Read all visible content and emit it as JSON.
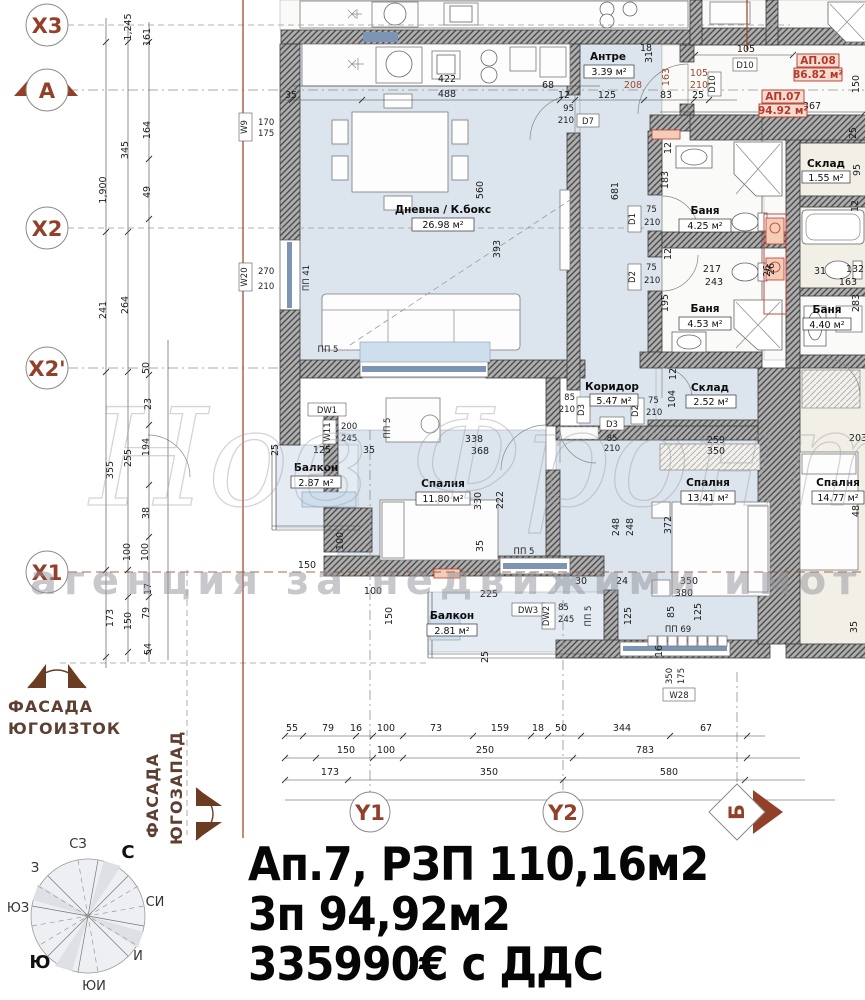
{
  "title": {
    "l1": "Ап.7, РЗП 110,16м2",
    "l2": "3п 94,92м2",
    "l3": "335990€ с ДДС"
  },
  "grid": {
    "x3": "X3",
    "a": "A",
    "x2": "X2",
    "x2p": "X2'",
    "x1": "X1",
    "y1": "Y1",
    "y2": "Y2",
    "b": "Б"
  },
  "facades": {
    "f1a": "ФАСАДА",
    "f1b": "ЮГОИЗТОК",
    "f2a": "ФАСАДА",
    "f2b": "ЮГОЗАПАД"
  },
  "compass": {
    "n": "С",
    "ne": "СИ",
    "e": "И",
    "se": "ЮИ",
    "s": "Ю",
    "sw": "ЮЗ",
    "w": "З",
    "nw": "СЗ"
  },
  "apts": {
    "a7": "АП.07",
    "a7s": "94.92 м²",
    "a8": "АП.08",
    "a8s": "86.82 м²"
  },
  "rooms": {
    "living": {
      "n": "Дневна / К.бокс",
      "a": "26.98 м²"
    },
    "entry": {
      "n": "Антре",
      "a": "3.39 м²"
    },
    "bath1": {
      "n": "Баня",
      "a": "4.25 м²"
    },
    "bath2": {
      "n": "Баня",
      "a": "4.53 м²"
    },
    "storage1": {
      "n": "Склад",
      "a": "2.52 м²"
    },
    "corridor": {
      "n": "Коридор",
      "a": "5.47 м²"
    },
    "bed1": {
      "n": "Спалня",
      "a": "11.80 м²"
    },
    "bed2": {
      "n": "Спалня",
      "a": "13.41 м²"
    },
    "balc1": {
      "n": "Балкон",
      "a": "2.87 м²"
    },
    "balc2": {
      "n": "Балкон",
      "a": "2.81 м²"
    },
    "storage2": {
      "n": "Склад",
      "a": "1.55 м²"
    },
    "bath3": {
      "n": "Баня",
      "a": "4.40 м²"
    },
    "bed3": {
      "n": "Спалня",
      "a": "14.77 м²"
    }
  },
  "tags": {
    "w9": "W9",
    "w9v1": "170",
    "w9v2": "175",
    "w20": "W20",
    "w20v1": "270",
    "w20v2": "210",
    "pp41": "ПП 41",
    "pp5": "ПП 5",
    "pp69": "ПП 69",
    "dw1": "DW1",
    "w11": "W11",
    "w11v1": "200",
    "w11v2": "245",
    "d7": "D7",
    "d7v1": "95",
    "d7v2": "210",
    "d10": "D10",
    "d1": "D1",
    "d1v1": "75",
    "d1v2": "210",
    "d2": "D2",
    "d2v1": "75",
    "d2v2": "210",
    "d3": "D3",
    "d3v1": "85",
    "d3v2": "210",
    "dw2": "DW2",
    "dw3": "DW3",
    "dw3v1": "85",
    "dw3v2": "245",
    "w28": "W28",
    "w28v1": "350",
    "w28v2": "175"
  },
  "dims": {
    "left": [
      "1,245",
      "161",
      "1,900",
      "345",
      "164",
      "49",
      "241",
      "264",
      "355",
      "255",
      "194",
      "50",
      "23",
      "38",
      "100",
      "100",
      "17",
      "173",
      "150",
      "79",
      "54"
    ],
    "top": [
      "422",
      "488",
      "35",
      "68",
      "12",
      "125",
      "83",
      "25",
      "105",
      "18",
      "367",
      "31",
      "150",
      "560",
      "393",
      "105",
      "210",
      "163",
      "208"
    ],
    "right": [
      "25",
      "95",
      "12",
      "26",
      "31",
      "132",
      "163",
      "283",
      "203",
      "488",
      "35"
    ],
    "bath": [
      "183",
      "12",
      "217",
      "243",
      "26",
      "195",
      "12",
      "681"
    ],
    "mid": [
      "104",
      "12",
      "259",
      "350",
      "372",
      "248",
      "248",
      "30",
      "24",
      "350",
      "380",
      "338",
      "368",
      "330",
      "222",
      "35",
      "100",
      "150",
      "100",
      "150",
      "125",
      "35",
      "25",
      "225",
      "125",
      "85",
      "125",
      "16",
      "25"
    ],
    "b1": [
      "55",
      "79",
      "16",
      "100",
      "73",
      "159",
      "18",
      "50",
      "344",
      "67"
    ],
    "b2": [
      "150",
      "100",
      "250",
      "783"
    ],
    "b3": [
      "173",
      "350",
      "580"
    ]
  },
  "watermark": {
    "brand": "Нов Фронт",
    "sub": "агенция за недвижими имоти"
  }
}
